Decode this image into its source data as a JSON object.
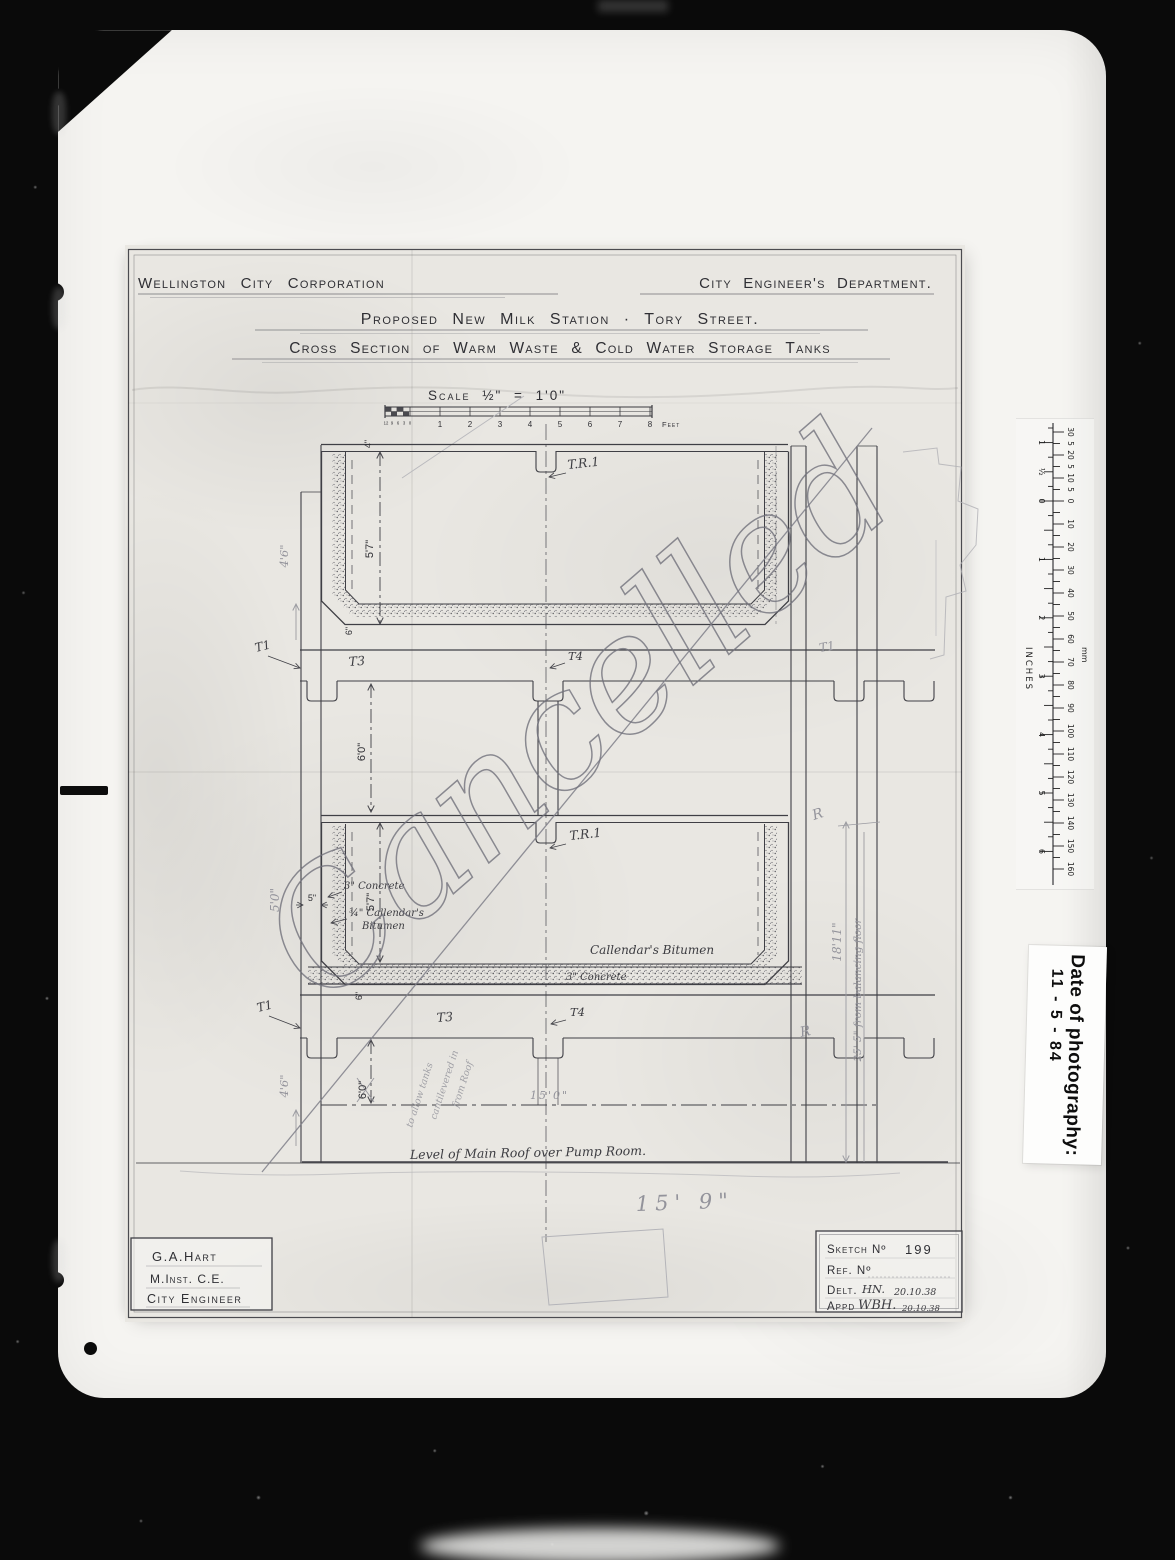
{
  "photo_label": {
    "title": "Date of photography:",
    "value": "11 - 5 - 84"
  },
  "ruler": {
    "unit_top": "mm",
    "unit_side": "INCHES",
    "mm_upper": [
      "30",
      "5",
      "20",
      "5",
      "10",
      "5"
    ],
    "mm_lower": [
      "0",
      "10",
      "20",
      "30",
      "40",
      "50",
      "60",
      "70",
      "80",
      "90",
      "100",
      "110",
      "120",
      "130",
      "140",
      "150",
      "160"
    ],
    "inch_upper": [
      "1",
      "½"
    ],
    "inch_lower": [
      "0",
      "1",
      "2",
      "3",
      "4",
      "5",
      "6"
    ]
  },
  "sheet": {
    "org": "Wellington City Corporation",
    "dept": "City Engineer's Department.",
    "title1": "Proposed New Milk Station · Tory Street.",
    "title2": "Cross Section of Warm Waste & Cold Water Storage Tanks",
    "scale": {
      "label": "Scale ½\" = 1'0\"",
      "feet": [
        "1",
        "2",
        "3",
        "4",
        "5",
        "6",
        "7",
        "8"
      ],
      "inches_sub": [
        "12",
        "9",
        "6",
        "3",
        "0"
      ],
      "unit": "Feet"
    },
    "watermark": "Cancelled",
    "titleblock": {
      "name": "G.A.Hart",
      "qualification": "M.Inst. C.E.",
      "role": "City Engineer"
    },
    "sketchblock": {
      "sketch_label": "Sketch Nº",
      "sketch_no": "199",
      "ref_label": "Ref. Nº",
      "delt_label": "Delt.",
      "delt_initials": "HN.",
      "delt_date": "20.10.38",
      "appd_label": "Appd",
      "appd_signature": "WBH.",
      "appd_date": "20.10.38"
    }
  },
  "annotations": {
    "tank_top_ref": "T.R.1",
    "tank_mid_ref": "T.R.1",
    "t1_upper_left": "T1",
    "t3_upper": "T3",
    "t4_upper": "T4",
    "t1_upper_right": "T1",
    "t1_lower_left": "T1",
    "t3_lower": "T3",
    "t4_lower": "T4",
    "dim_wall_top": "4\"",
    "dim_tank1_depth": "5'7\"",
    "dim_tank1_left": "4'6\"",
    "dim_tank1_floor": "6\"",
    "dim_between": "6'0\"",
    "dim_tank2_depth": "5'7\"",
    "dim_tank2_left": "5'0\"",
    "dim_wall_5": "5\"",
    "dim_tank2_floor": "6\"",
    "dim_lower_left": "4'6\"",
    "dim_lower_mid": "6'0\"",
    "dim_15_0": "15'0\"",
    "dim_15_9": "15' 9\"",
    "dim_18_11": "18'11\"",
    "dim_25_5": "25' 5\" from balancing floor",
    "note_concrete_wall": "3\" Concrete",
    "note_bitumen_1": "¾\" Callendar's",
    "note_bitumen_2": "Bitumen",
    "note_bitumen_floor": "Callendar's Bitumen",
    "note_concrete_floor": "3\" Concrete",
    "note_roof": "Level of Main Roof over Pump Room.",
    "pencil_r_upper": "R",
    "pencil_r_lower": "R",
    "pencil_note_1": "to allow tanks",
    "pencil_note_2": "cantilevered in",
    "pencil_note_3": "from Roof"
  }
}
